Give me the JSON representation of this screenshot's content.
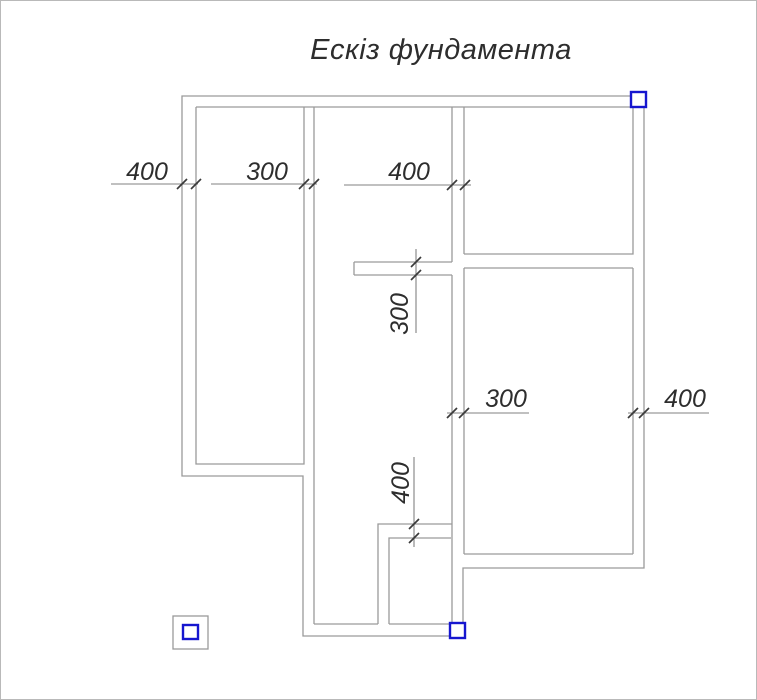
{
  "title": "Ескіз фундамента",
  "drawing": {
    "kind": "foundation-plan-sketch",
    "dimension_values": [
      "400",
      "300",
      "400",
      "300",
      "300",
      "400",
      "400"
    ]
  },
  "colors": {
    "wall": "#9a9a9a",
    "dim_line": "#808080",
    "tick": "#3a3a3a",
    "text": "#2d2d2d",
    "marker": "#1616cf",
    "background": "#ffffff",
    "frame": "#b9b9b9"
  },
  "dimensions": [
    {
      "id": "dim-400-top-left",
      "value": "400",
      "orientation": "horizontal",
      "line": {
        "x1": 110,
        "y1": 183,
        "x2": 197,
        "y2": 183
      },
      "ticks": [
        [
          181,
          183
        ],
        [
          195,
          183
        ]
      ],
      "label": {
        "x": 146,
        "y": 179,
        "rotate": false
      }
    },
    {
      "id": "dim-300-top-left",
      "value": "300",
      "orientation": "horizontal",
      "line": {
        "x1": 210,
        "y1": 183,
        "x2": 316,
        "y2": 183
      },
      "ticks": [
        [
          303,
          183
        ],
        [
          313,
          183
        ]
      ],
      "label": {
        "x": 266,
        "y": 179,
        "rotate": false
      }
    },
    {
      "id": "dim-400-top-middle",
      "value": "400",
      "orientation": "horizontal",
      "line": {
        "x1": 343,
        "y1": 184,
        "x2": 470,
        "y2": 184
      },
      "ticks": [
        [
          451,
          184
        ],
        [
          464,
          184
        ]
      ],
      "label": {
        "x": 408,
        "y": 179,
        "rotate": false
      }
    },
    {
      "id": "dim-300-vertical",
      "value": "300",
      "orientation": "vertical",
      "line": {
        "x1": 415,
        "y1": 248,
        "x2": 415,
        "y2": 332
      },
      "ticks": [
        [
          415,
          261
        ],
        [
          415,
          274
        ]
      ],
      "label": {
        "x": 401,
        "y": 313,
        "rotate": true
      }
    },
    {
      "id": "dim-400-vertical",
      "value": "400",
      "orientation": "vertical",
      "line": {
        "x1": 413,
        "y1": 456,
        "x2": 413,
        "y2": 546
      },
      "ticks": [
        [
          413,
          523
        ],
        [
          413,
          537
        ]
      ],
      "label": {
        "x": 402,
        "y": 482,
        "rotate": true
      }
    },
    {
      "id": "dim-300-middle-right",
      "value": "300",
      "orientation": "horizontal",
      "line": {
        "x1": 446,
        "y1": 412,
        "x2": 528,
        "y2": 412
      },
      "ticks": [
        [
          451,
          412
        ],
        [
          463,
          412
        ]
      ],
      "label": {
        "x": 505,
        "y": 406,
        "rotate": false
      }
    },
    {
      "id": "dim-400-right",
      "value": "400",
      "orientation": "horizontal",
      "line": {
        "x1": 627,
        "y1": 412,
        "x2": 708,
        "y2": 412
      },
      "ticks": [
        [
          632,
          412
        ],
        [
          643,
          412
        ]
      ],
      "label": {
        "x": 684,
        "y": 406,
        "rotate": false
      }
    }
  ],
  "markers": [
    {
      "id": "corner-marker-top-right",
      "x": 630,
      "y": 91,
      "w": 15,
      "h": 15
    },
    {
      "id": "corner-marker-bottom",
      "x": 449,
      "y": 622,
      "w": 15,
      "h": 15
    }
  ],
  "legend_symbol": {
    "outer": {
      "x": 172,
      "y": 615,
      "w": 35,
      "h": 33
    },
    "inner": {
      "x": 182,
      "y": 624,
      "w": 15,
      "h": 14
    }
  }
}
